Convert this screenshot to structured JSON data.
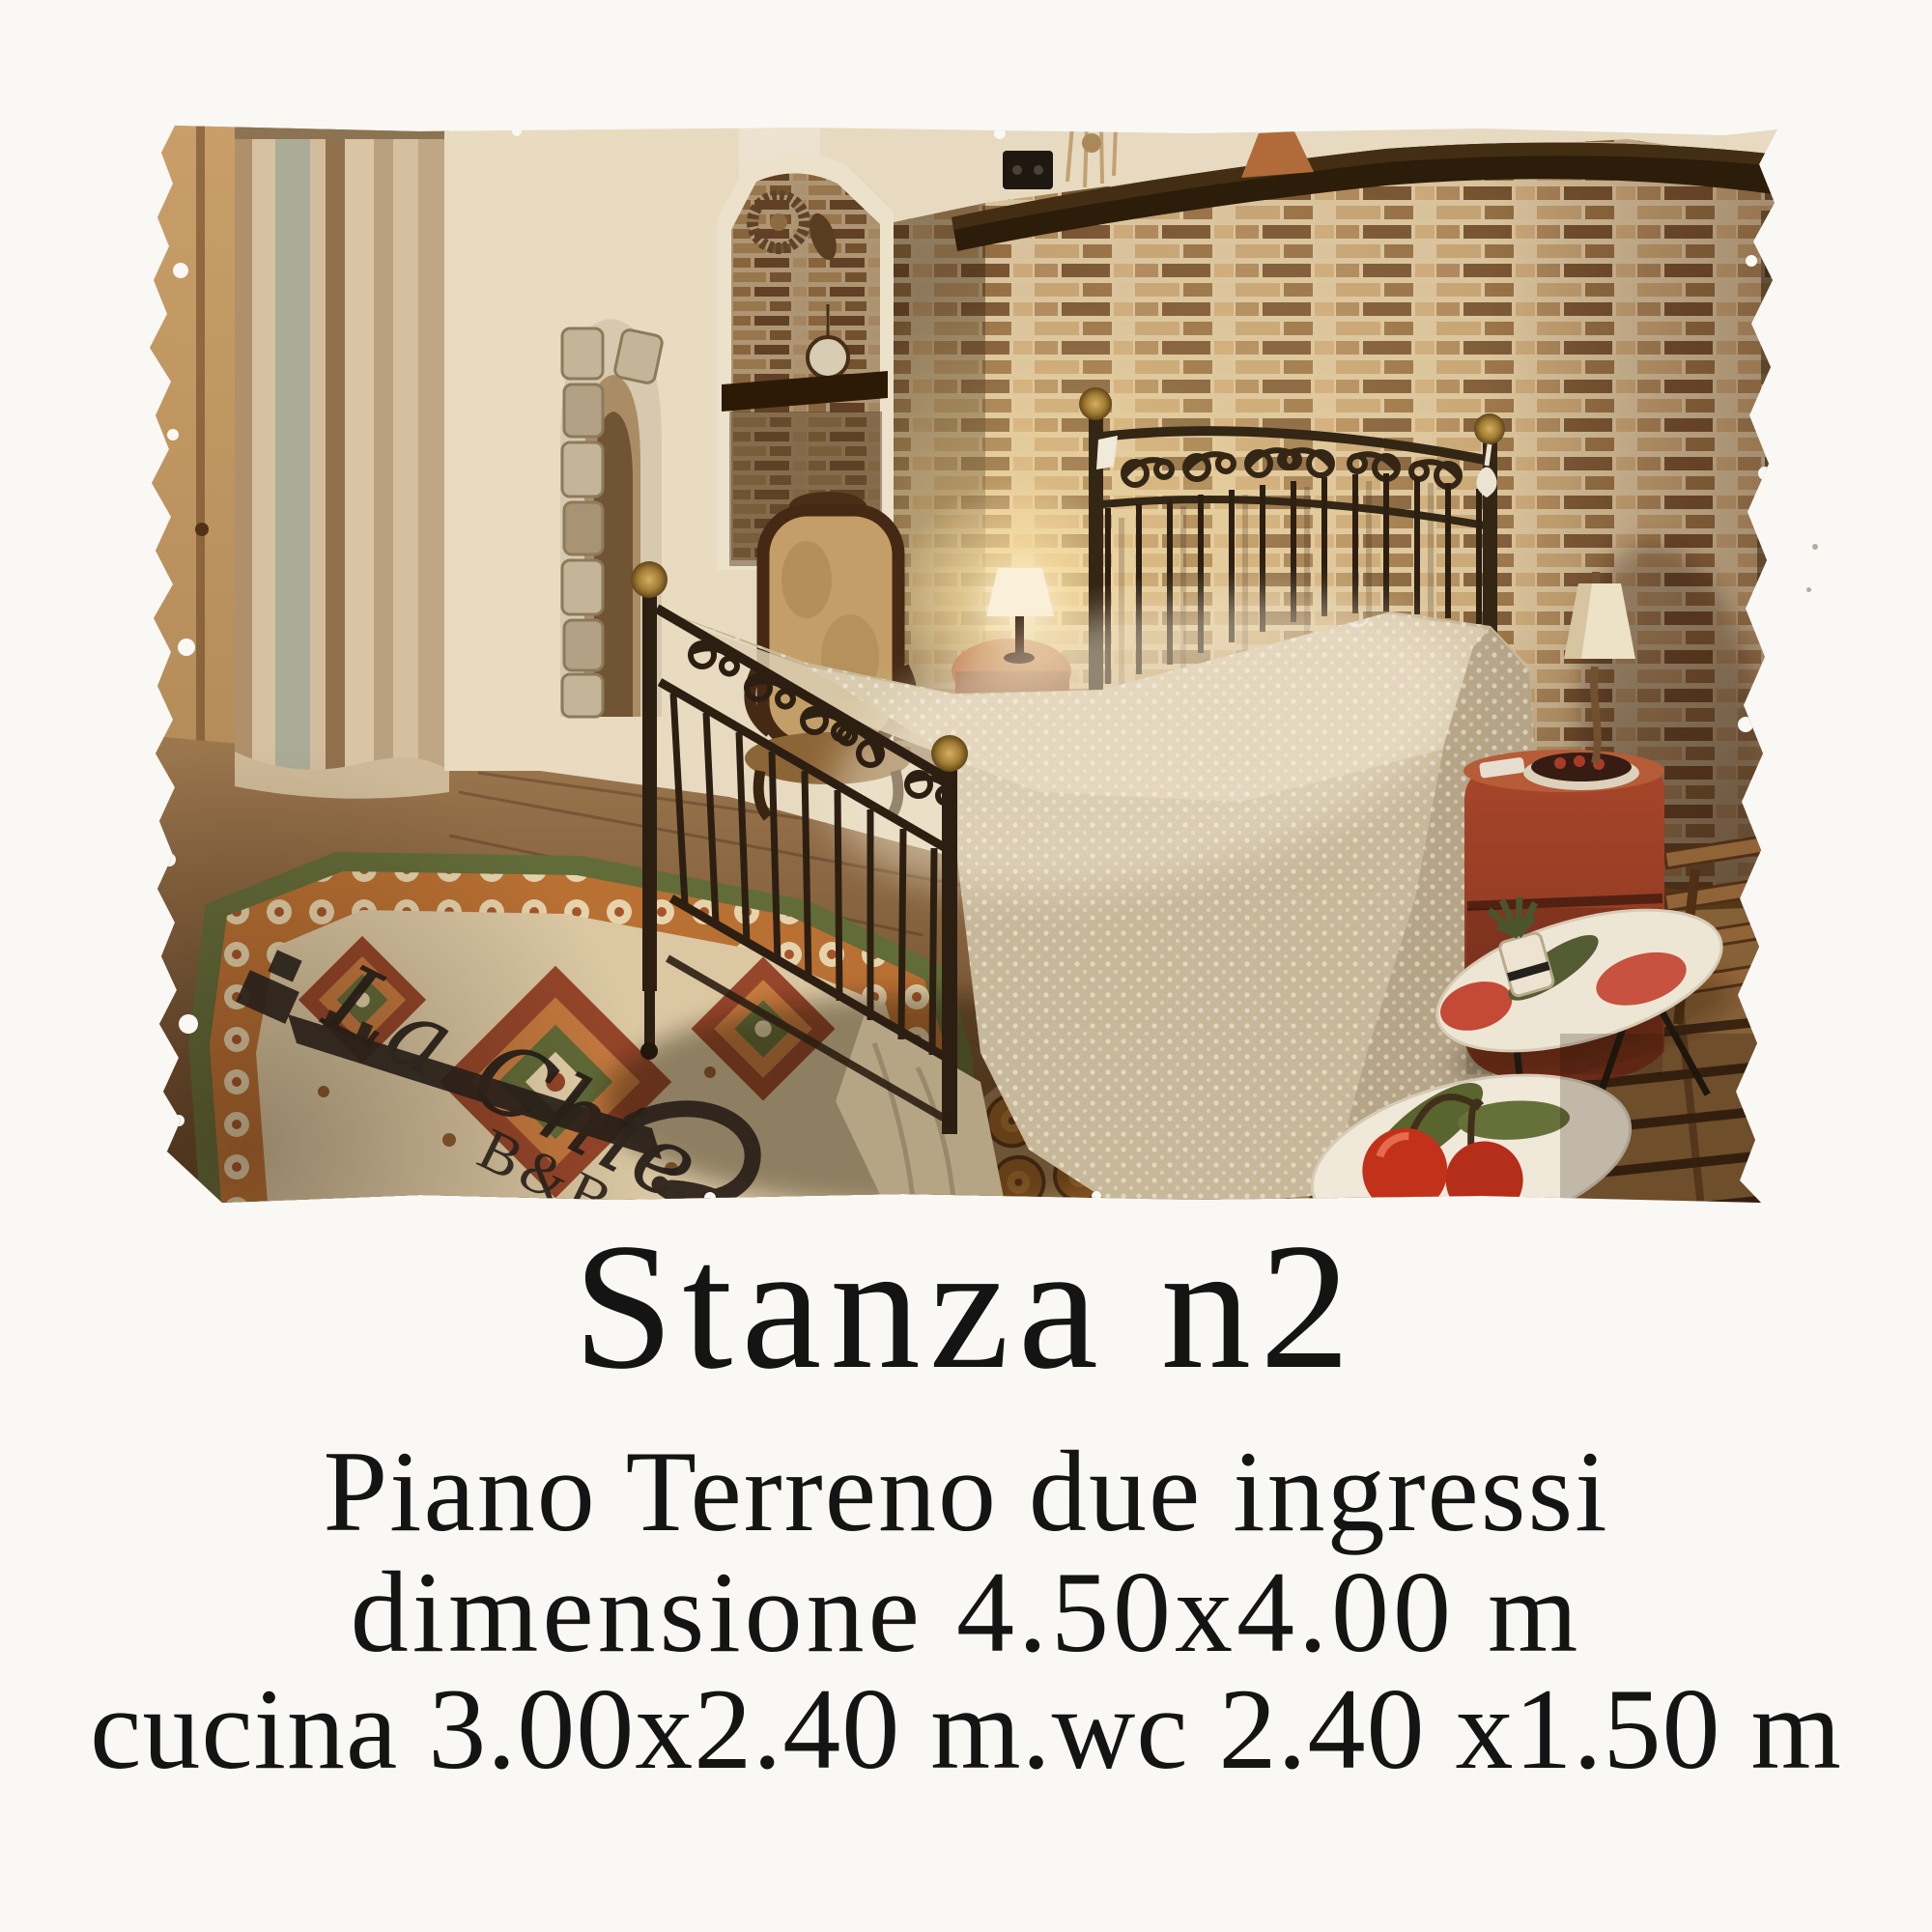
{
  "caption": {
    "title": "Stanza n2",
    "line1": "Piano Terreno due ingressi",
    "line2": "dimensione 4.50x4.00 m",
    "line3": "cucina 3.00x2.40 m.wc 2.40 x1.50 m"
  },
  "watermark": {
    "script": "La Chie",
    "label": "B&B"
  },
  "photo": {
    "alt": "bedroom with wrought-iron double bed, mosaic brick wall, beige curtain, stone arch niche, patterned rug, red nightstand, oval cherry tray tables",
    "colors": {
      "page_bg": "#faf8f5",
      "text": "#141414",
      "brick": "#c3a175",
      "mortar": "#d9c6a4",
      "bedspread": "#c8bb9f",
      "metal": "#241a10",
      "brass": "#caa24e",
      "curtain": "#c9b594",
      "rug_green": "#5d6b39",
      "rug_orange": "#b96f33",
      "rug_cream": "#ddcca9",
      "nightstand_red": "#a8432a",
      "cherry_red": "#c22e1a",
      "wood_floor": "#8a6543",
      "watermark_ink": "#292019"
    }
  }
}
